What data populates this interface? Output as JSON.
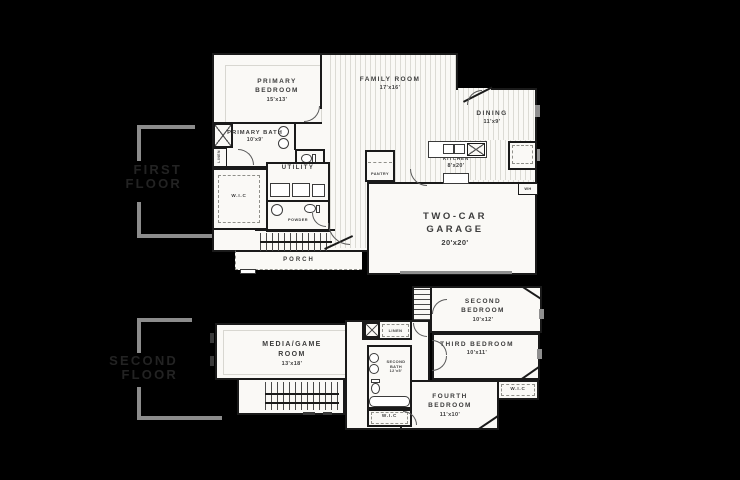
{
  "page": {
    "background": "#000000",
    "paper": "#faf9f6",
    "wall_color": "#1a1a1a",
    "hatch_color": "#dcdbd5",
    "bracket_color": "#8c8c8c",
    "floor_label_color": "#232323"
  },
  "floor_labels": {
    "first": {
      "line1": "FIRST",
      "line2": "FLOOR"
    },
    "second": {
      "line1": "SECOND",
      "line2": "FLOOR"
    }
  },
  "first_floor": {
    "primary_bedroom": {
      "name": "PRIMARY BEDROOM",
      "dim": "15'x13'"
    },
    "family_room": {
      "name": "FAMILY ROOM",
      "dim": "17'x16'"
    },
    "dining": {
      "name": "DINING",
      "dim": "11'x9'"
    },
    "kitchen": {
      "name": "KITCHEN",
      "dim": "8'x20'"
    },
    "primary_bath": {
      "name": "PRIMARY BATH",
      "dim": "10'x9'"
    },
    "utility": {
      "name": "UTILITY"
    },
    "wic": {
      "name": "W.I.C"
    },
    "powder": {
      "name": "POWDER"
    },
    "pantry": {
      "name": "PANTRY"
    },
    "linen": {
      "name": "LINEN"
    },
    "garage": {
      "name": "TWO-CAR GARAGE",
      "dim": "20'x20'"
    },
    "porch": {
      "name": "PORCH"
    },
    "water_heater": {
      "name": "WH"
    }
  },
  "second_floor": {
    "media_game_room": {
      "name": "MEDIA/GAME ROOM",
      "dim": "13'x18'"
    },
    "second_bedroom": {
      "name": "SECOND BEDROOM",
      "dim": "10'x12'"
    },
    "third_bedroom": {
      "name": "THIRD BEDROOM",
      "dim": "10'x11'"
    },
    "fourth_bedroom": {
      "name": "FOURTH BEDROOM",
      "dim": "11'x10'"
    },
    "second_bath": {
      "name": "SECOND BATH",
      "dim": "12'x5'"
    },
    "linen": {
      "name": "LINEN"
    },
    "wic_left": {
      "name": "W.I.C"
    },
    "wic_right": {
      "name": "W.I.C"
    }
  }
}
